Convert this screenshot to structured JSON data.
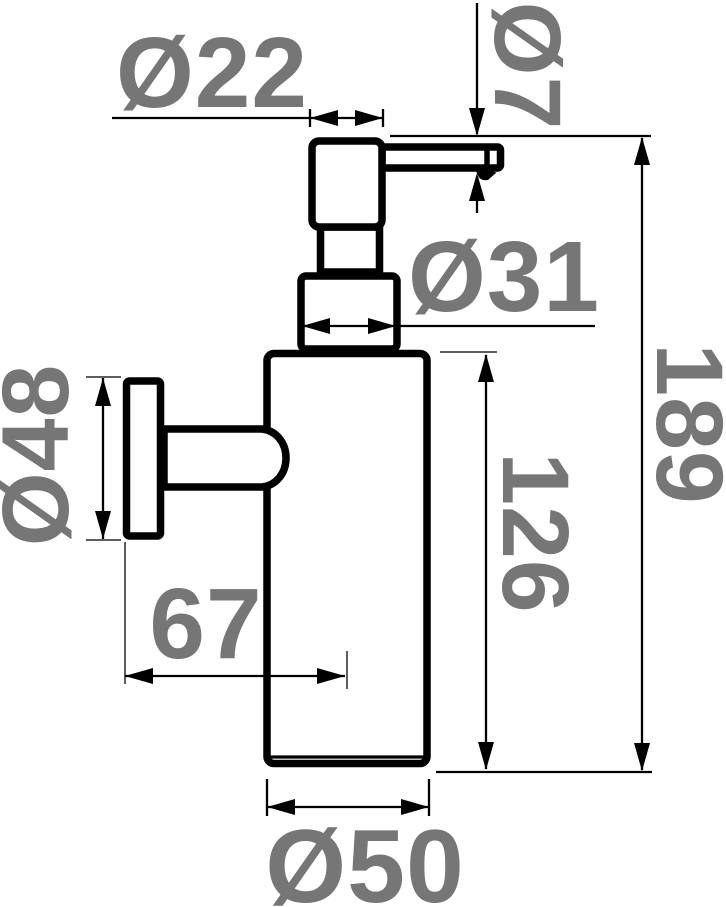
{
  "page": {
    "background_color": "#ffffff"
  },
  "drawing": {
    "subject": "wall-mounted soap dispenser - side elevation technical drawing",
    "outline_color": "#000000",
    "dimension_line_color": "#000000",
    "dimension_label_color": "#767676",
    "dimensions": {
      "pump_head_width": "Ø22",
      "spout_diameter": "Ø7",
      "collar_diameter": "Ø31",
      "wall_plate_diameter": "Ø48",
      "overall_height": "189",
      "body_height": "126",
      "wall_to_body_center": "67",
      "body_diameter": "Ø50"
    }
  }
}
